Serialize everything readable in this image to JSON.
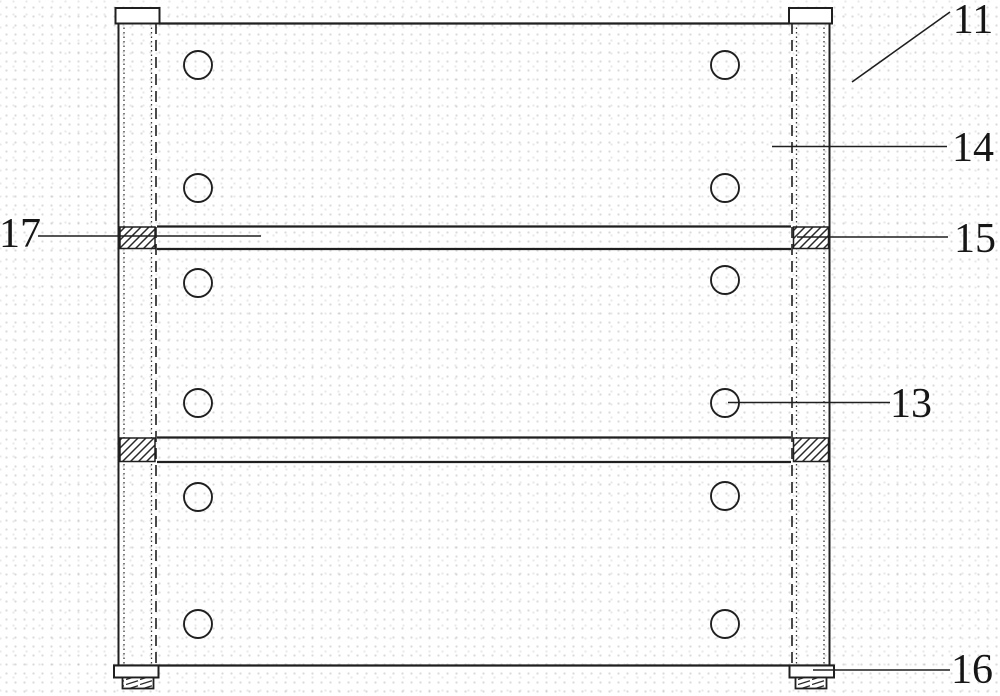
{
  "figure": {
    "background_color": "#ffffff",
    "line_color": "#1f1f1f"
  },
  "labels": {
    "ref11": "11",
    "ref13": "13",
    "ref14": "14",
    "ref15": "15",
    "ref16": "16",
    "ref17": "17"
  }
}
